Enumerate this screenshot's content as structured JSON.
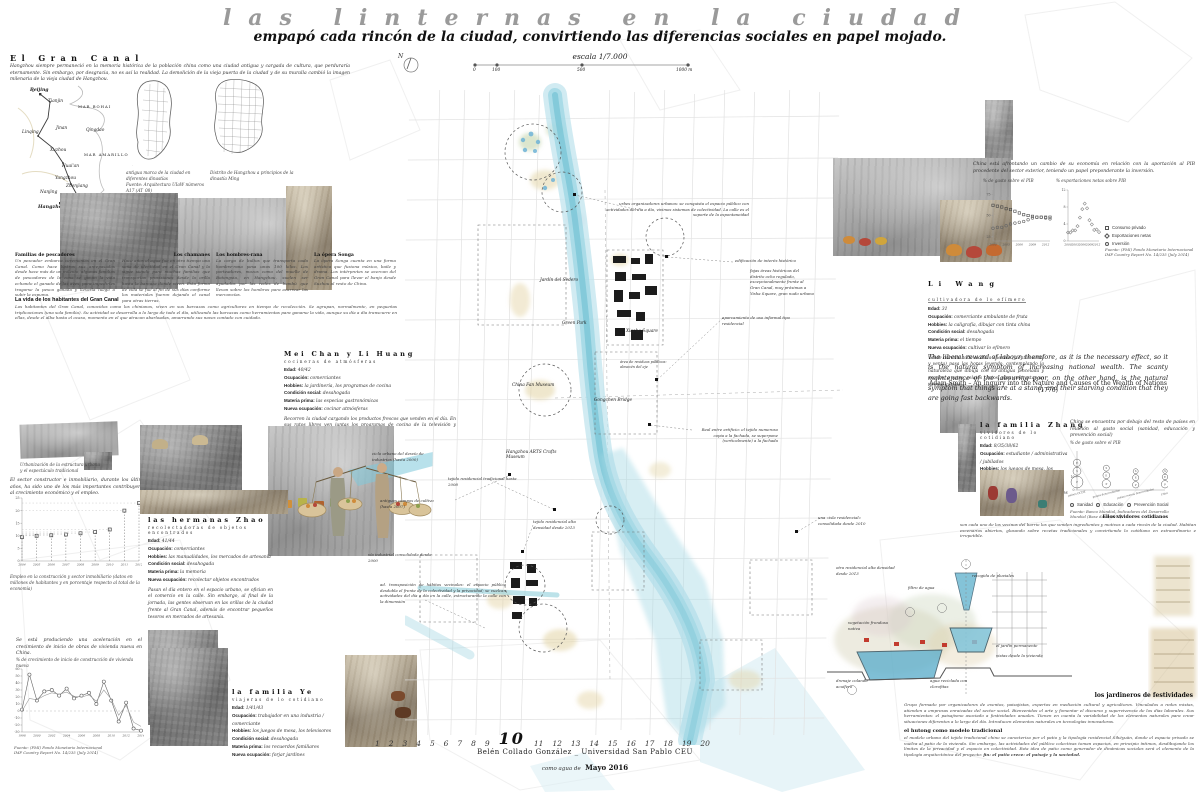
{
  "poster": {
    "title": "las linternas en la ciudad",
    "subtitle": "empapó cada rincón de la ciudad, convirtiendo las diferencias sociales en papel mojado."
  },
  "scalebar": {
    "escala": "escala 1/7.000",
    "north": "N",
    "ticks": [
      "0",
      "100",
      "500",
      "1000 m"
    ]
  },
  "gran_canal": {
    "heading": "El Gran Canal",
    "intro": "Hangzhou siempre permaneció en la memoria histórica de la población china como una ciudad antigua y cargada de cultura, que perduraría eternamente. Sin embargo, por desgracia, no es así la realidad. La demolición de la vieja puerta de la ciudad y de su muralla cambió la imagen milenaria de la vieja ciudad de Hangzhou.",
    "map_caption_1": "antigua marca de la ciudad en diferentes dinastías",
    "map_caption_1b": "Fuente: Arquitectura UIaW números A17 (AT_08)",
    "map_caption_2": "Distrito de Hangzhou a principios de la dinastía Ming",
    "china_labels": [
      "Beijing",
      "Tianjin",
      "MAR BOHAI",
      "Linqing",
      "Jinan",
      "Qingdao",
      "Xuzhou",
      "MAR AMARILLO",
      "Huai'an",
      "Yangzhou",
      "Zhenjiang",
      "Nanjing",
      "Suzhou",
      "Shanghai",
      "Hangzhou"
    ],
    "sections": [
      {
        "heading": "Familias de pescadores",
        "text": "Un pescador embarca ceremonias en el Gran Canal. Como hace lustros sus antepasados desde hace más de un milenio, algunas familias de pescadores de la zona se ganan la vida echando el ganado de las aves, para impedirles tragarse la pesca ganada y llevarla luego a subir la espuma."
      },
      {
        "heading": "Los chamanes",
        "text": "Hace años el agua fue en otro tiempo una seña de identidad en el Gran Canal y la sigue siendo para muchas familias que transportan provisiones desde la orilla hasta la barcaza donde viven. Esta forma de vida se fue al fin de sus días conforme los materiales fueron dejando el canal para otras tierras."
      },
      {
        "heading": "Los hombres-rana",
        "text": "La carga de bultos que transporta cada hombre-rana pesa unos 100 kilos. Los porteadores, mozos como del muelle de Botongxia, en Hangzhou, suelen ser ayudados por las redes de bambú que llevan sobre los hombros para acarrear las mercancías."
      },
      {
        "heading": "La ópera Songa",
        "text": "La ópera Songa cuenta en una forma artística que fusiona música, baile y drama. Los intérpretes se acercan del Gran Canal para llevar el banjo desde Suzhou al resto de China."
      }
    ],
    "vida_heading": "La vida de los habitantes del Gran Canal",
    "vida_text": "Los habitantes del Gran Canal, conocidos como los chinianos, viven en sus barcazas como agricultores en tiempo de recolección. Se agrupan, normalmente, en pequeñas triplicaciones (una sola familia). Su actividad se desarrolla a lo largo de todo el día, utilizando las barcazas como herramientas para ganarse la vida, aunque su día a día transcurre en ellas, desde el alba hasta el ocaso, momento en el que atracan abarloadas, amarrando sus naves contado con cuidado."
  },
  "construccion": {
    "photo_caption": "Urbanización de la estructura urbana y el espectáculo tradicional",
    "text": "El sector constructor e inmobiliario, durante los últimos años, ha sido uno de los más importantes contribuyentes al crecimiento económico y el empleo.",
    "chart_caption": "Empleo en la construcción y sector inmobiliario (datos en millones de habitantes y en porcentaje respecto al total de la economía)"
  },
  "vivienda": {
    "text": "Se está produciendo una aceleración en el crecimiento de inicio de obras de vivienda nueva en China.",
    "chart_label": "% de crecimiento de inicio de construcción de vivienda nueva",
    "source_1": "Fuente: (FMI) Fondo Monetario Internacional",
    "source_2": "IMF Country Report No. 14/235 (July 2014)"
  },
  "profiles": [
    {
      "name": "Mei Chan y Li Huang",
      "subtitle": "cocineras de atmósferas",
      "fields": [
        {
          "l": "Edad:",
          "v": "40/42"
        },
        {
          "l": "Ocupación:",
          "v": "comerciantes"
        },
        {
          "l": "Hobbies:",
          "v": "la jardinería, los programas de cocina"
        },
        {
          "l": "Condición social:",
          "v": "desahogada"
        },
        {
          "l": "Materia prima:",
          "v": "las especias gastronómicas"
        },
        {
          "l": "Nueva ocupación:",
          "v": "cocinar atmósferas"
        }
      ],
      "paragraph": "Recorren la ciudad cargando los productos frescos que venden en el día. En sus ratos libres ven juntas los programas de cocina de la televisión y experimentan nuevas recetas."
    },
    {
      "name": "las hermanas Zhao",
      "subtitle": "recolectadoras de objetos encontrados",
      "fields": [
        {
          "l": "Edad:",
          "v": "41/44"
        },
        {
          "l": "Ocupación:",
          "v": "comerciantes"
        },
        {
          "l": "Hobbies:",
          "v": "las manualidades, los mercados de artesanía"
        },
        {
          "l": "Condición social:",
          "v": "desahogada"
        },
        {
          "l": "Materia prima:",
          "v": "la memoria"
        },
        {
          "l": "Nueva ocupación:",
          "v": "recolectar objetos encontrados"
        }
      ],
      "paragraph": "Pasan el día entero en el espacio urbano, se ofician en el comercio en la calle. Sin embargo, al final de la jornada, las gentes observan en las orillas de la ciudad frente al Gran Canal, además de encontrar pequeños tesoros en mercados de artesanía."
    },
    {
      "name": "la familia Ye",
      "subtitle": "viajeras de lo cotidiano",
      "fields": [
        {
          "l": "Edad:",
          "v": "1/41/43"
        },
        {
          "l": "Ocupación:",
          "v": "trabajador en una industria / comerciante"
        },
        {
          "l": "Hobbies:",
          "v": "los juegos de mesa, los televisores"
        },
        {
          "l": "Condición social:",
          "v": "desahogada"
        },
        {
          "l": "Materia prima:",
          "v": "los recuerdos familiares"
        },
        {
          "l": "Nueva ocupación:",
          "v": "forjar jardines"
        }
      ],
      "paragraph": ""
    },
    {
      "name": "Li Wang",
      "subtitle": "cultivadora de lo efímero",
      "fields": [
        {
          "l": "Edad:",
          "v": "31"
        },
        {
          "l": "Ocupación:",
          "v": "comerciante ambulante de fruta"
        },
        {
          "l": "Hobbies:",
          "v": "la caligrafía, dibujar con tinta china"
        },
        {
          "l": "Condición social:",
          "v": "desahogada"
        },
        {
          "l": "Materia prima:",
          "v": "el tiempo"
        },
        {
          "l": "Nueva ocupación:",
          "v": "cultivar lo efímero"
        }
      ],
      "paragraph": "Vende durante todo el día a clientes (y entre venta y venta) pasa las horas leyendo, contemplando la naturaleza que dibuja con su antigua pincelada y escribe, a ratos, relatos cortos, para contrastar un tiempo infinito."
    },
    {
      "name": "la familia Zhang",
      "subtitle": "vividores de lo cotidiano",
      "fields": [
        {
          "l": "Edad:",
          "v": "8/35/38/62"
        },
        {
          "l": "Ocupación:",
          "v": "estudiante / administrativa / jubilados"
        },
        {
          "l": "Hobbies:",
          "v": "los juegos de mesa, los televisores"
        },
        {
          "l": "Condición social:",
          "v": "desahogada"
        },
        {
          "l": "Materia prima:",
          "v": "los momentos familiares"
        },
        {
          "l": "Nueva ocupación:",
          "v": "forjar jardines"
        }
      ],
      "paragraph": ""
    }
  ],
  "economia": {
    "text": "China está afrontando un cambio de su economía en relación con la aportación al PIB procedente del sector exterior, teniendo un papel preponderante la inversión.",
    "chart_title_1": "% de gasto sobre el PIB",
    "chart_title_2": "% exportaciones netas sobre PIB",
    "legend": [
      "Consumo privado",
      "Exportaciones netas",
      "Inversión"
    ],
    "source_1": "Fuente: (FMI) Fondo Monetario Internacional",
    "source_2": "IMF Country Report No. 14/235 (July 2014)"
  },
  "quote": {
    "text": "The liberal reward of labour, therefore, as it is the necessary effect, so it is the natural symptom of increasing national wealth. The scanty maintenance of the labouring poor, on the other hand, is the natural symptom that things are at a stand, and their starving condition that they are going fast backwards.",
    "attribution": "Adam Smith – An Inquiry into the Nature and Causes of the Wealth of Nations (1776)"
  },
  "social": {
    "text": "China se encuentra por debajo del resto de países en relación al gasto social (sanidad, educación y prevención social)",
    "chart_title": "% de gasto sobre el PIB",
    "legend": [
      "Sanidad",
      "Educación",
      "Prevención Social"
    ],
    "source": "Fuente: Banco Mundial, Indicadores del Desarrollo Mundial (Base datos 2011)",
    "vividores_heading": "Ellos vividores cotidianos",
    "vividores_text": "son cada uno de los vecinos del barrio los que venden ingredientes y motivos a cada rincón de la ciudad. Habitan escenarios abiertos, glosando sobre recetas tradicionales y convirtiendo lo cotidiano en extraordinario e irrepetible."
  },
  "map": {
    "labels": [
      "Jardín del Sedero",
      "Green Park",
      "China Fan Museum",
      "Gongchen Bridge",
      "Hangzhou ARTS Crafts Museum",
      "Xiaohe Square"
    ],
    "annotations": [
      "urbes organizadores urbanos: se conquista el espacio público con actividades del día a día, vivimos sistemas de colectividad. La calle es el soporte de la espontaneidad",
      "edificación de interés histórico",
      "fajas áreas históricas del distrito ocho regulado, excepcionalmente frente al Gran Canal, muy próximas a Yisha Square, gran nudo urbano",
      "aparcamiento de uso informal tipo residencial",
      "área de residuos públicos: almacén del eje",
      "ciclo urbano del desvío de industrias (hasta 2000)",
      "tejido residencial tradicional hasta 2008",
      "antiguos campos de cultivo (hasta 2007)",
      "tejido residencial alta densidad desde 2013",
      "vía industrial consolidada desde 2000",
      "ad. transposición de hábitos vecinales: el espacio público desdobla el frente de la colectividad y la privacidad; se vuelcan actividades del día a día en la calle, estructurando la calle con la dimensión",
      "Real entre artificio: el tejido numeroso copia a la fachada, se superpone (verticalmente) a la fachada",
      "una «isla residencial» consolidada desde 2010",
      "otra residencial alta densidad desde 2013"
    ]
  },
  "diagrama": {
    "labels": [
      "recogida de pluviales",
      "filtro de agua",
      "el jardín permanente",
      "vistas desde la vivienda",
      "agua reciclada con clorofitas",
      "drenaje colando acuífero",
      "vegetación frondosa nativa"
    ]
  },
  "jardineros": {
    "heading": "los jardineros de festividades",
    "text": "Grupo formado por organizadores de eventos, paisajistas, expertos en mediación cultural y agricultores. Vinculados a redes mixtas, atienden a empresas enraizadas del sector social. Bienvenidos el arte y fomentar el discurso y supervivencia de los días laborales. Sus herramientas: el paisajismo asociado a festividades anuales. Tienen en cuenta la variabilidad de los elementos naturales para crear situaciones diferentes a lo largo del día. Introducen elementos naturales en tecnologías innovadoras."
  },
  "hutong": {
    "heading": "el hutong como modelo tradicional",
    "text": "el modelo urbano del tejido tradicional chino se caracteriza por el patio y la tipología residencial Síhéyuàn, donde el espacio privado se vuelca al patio de la vivienda. Sin embargo, las actividades del público colectivas toman espacios, en principio íntimos, desdibujando los límites de la privacidad y el espacio en colectividad. Esta idea de patio como generador de dinámicas sociales será el elemento de la tipología arquitectónica del proyecto: ",
    "bold_tail": "fin: el patio crece: el paisaje y la sociedad."
  },
  "footer": {
    "numbers": [
      "1",
      "2",
      "3",
      "4",
      "5",
      "6",
      "7",
      "8",
      "9",
      "10",
      "11",
      "12",
      "13",
      "14",
      "15",
      "16",
      "17",
      "18",
      "19",
      "20"
    ],
    "highlight": "10",
    "credit": "Belén Collado González _ Universidad San Pablo CEU",
    "date_prefix": "como agua de",
    "date": "Mayo 2016"
  },
  "chart_data": [
    {
      "el": "chart-empleo",
      "type": "stem",
      "title": "Empleo en la construcción y sector inmobiliario",
      "categories": [
        "2004",
        "2005",
        "2006",
        "2007",
        "2008",
        "2009",
        "2010",
        "2011",
        "2012"
      ],
      "series": [
        {
          "name": "empleo (millones / % del total)",
          "values": [
            9.5,
            10,
            10.2,
            10.5,
            11,
            11.5,
            12.5,
            20,
            23
          ]
        }
      ],
      "ylim": [
        0,
        25
      ],
      "yticks": [
        0,
        5,
        10,
        15,
        20,
        25
      ]
    },
    {
      "el": "chart-vivienda",
      "type": "line",
      "title": "% de crecimiento de inicio de construcción de vivienda nueva",
      "categories": [
        "1998",
        "1999",
        "2000",
        "2001",
        "2002",
        "2003",
        "2004",
        "2005",
        "2006",
        "2007",
        "2008",
        "2009",
        "2010",
        "2011",
        "2012",
        "2013",
        "2014"
      ],
      "xte": 2,
      "series": [
        {
          "name": "inicio de obras de vivienda nueva",
          "values": [
            2,
            52,
            15,
            28,
            30,
            22,
            32,
            18,
            22,
            26,
            10,
            42,
            15,
            -15,
            12,
            -25,
            -28
          ]
        },
        {
          "name": "tendencia",
          "values": [
            0,
            18,
            16,
            22,
            26,
            24,
            27,
            21,
            20,
            23,
            14,
            30,
            17,
            -6,
            8,
            -16,
            -22
          ]
        }
      ],
      "ylim": [
        -30,
        60
      ],
      "yticks": [
        -30,
        -20,
        -10,
        0,
        10,
        20,
        30,
        40,
        50,
        60
      ]
    },
    {
      "el": "chart-pib-gasto",
      "type": "scatter",
      "title": "% de gasto sobre el PIB",
      "categories": [
        "2000",
        "2001",
        "2002",
        "2003",
        "2004",
        "2005",
        "2006",
        "2007",
        "2008",
        "2009",
        "2010",
        "2011",
        "2012",
        "2013"
      ],
      "xte": 3,
      "series": [
        {
          "name": "Consumo privado",
          "marker": "sq",
          "values": [
            62,
            61,
            60,
            58,
            57,
            55,
            53,
            51,
            50,
            49,
            48,
            48,
            48,
            48
          ]
        },
        {
          "name": "Inversión",
          "marker": "ci",
          "values": [
            35,
            36,
            36,
            38,
            40,
            41,
            42,
            43,
            45,
            47,
            48,
            48,
            47,
            46
          ]
        }
      ],
      "ylim": [
        20,
        80
      ],
      "yticks": [
        25,
        50,
        75
      ]
    },
    {
      "el": "chart-pib-export",
      "type": "scatter",
      "title": "% exportaciones netas sobre PIB",
      "categories": [
        "2000",
        "2001",
        "2002",
        "2003",
        "2004",
        "2005",
        "2006",
        "2007",
        "2008",
        "2009",
        "2010",
        "2011",
        "2012",
        "2013"
      ],
      "xte": 3,
      "series": [
        {
          "name": "Exportaciones netas",
          "marker": "di",
          "values": [
            2,
            2,
            2.5,
            2.5,
            3.5,
            5.5,
            7.5,
            8.8,
            7.7,
            4.9,
            3.9,
            2.6,
            2.7,
            2.1
          ]
        }
      ],
      "ylim": [
        0,
        12
      ],
      "yticks": [
        0,
        4,
        8,
        12
      ]
    },
    {
      "el": "chart-social",
      "type": "bubble",
      "title": "% de gasto sobre el PIB",
      "categories": [
        "países OCDE",
        "países desarrollados",
        "países menos desarrollados",
        "China"
      ],
      "series": [
        {
          "name": "Sanidad",
          "values": [
            6.2,
            3.5,
            2.5,
            1.9
          ]
        },
        {
          "name": "Educación",
          "values": [
            5.3,
            4.5,
            3.8,
            3.1
          ]
        },
        {
          "name": "Prevención Social",
          "values": [
            14,
            7,
            4,
            5.4
          ]
        }
      ],
      "ylim": [
        0,
        30
      ],
      "yticks": [
        0,
        10
      ]
    }
  ]
}
